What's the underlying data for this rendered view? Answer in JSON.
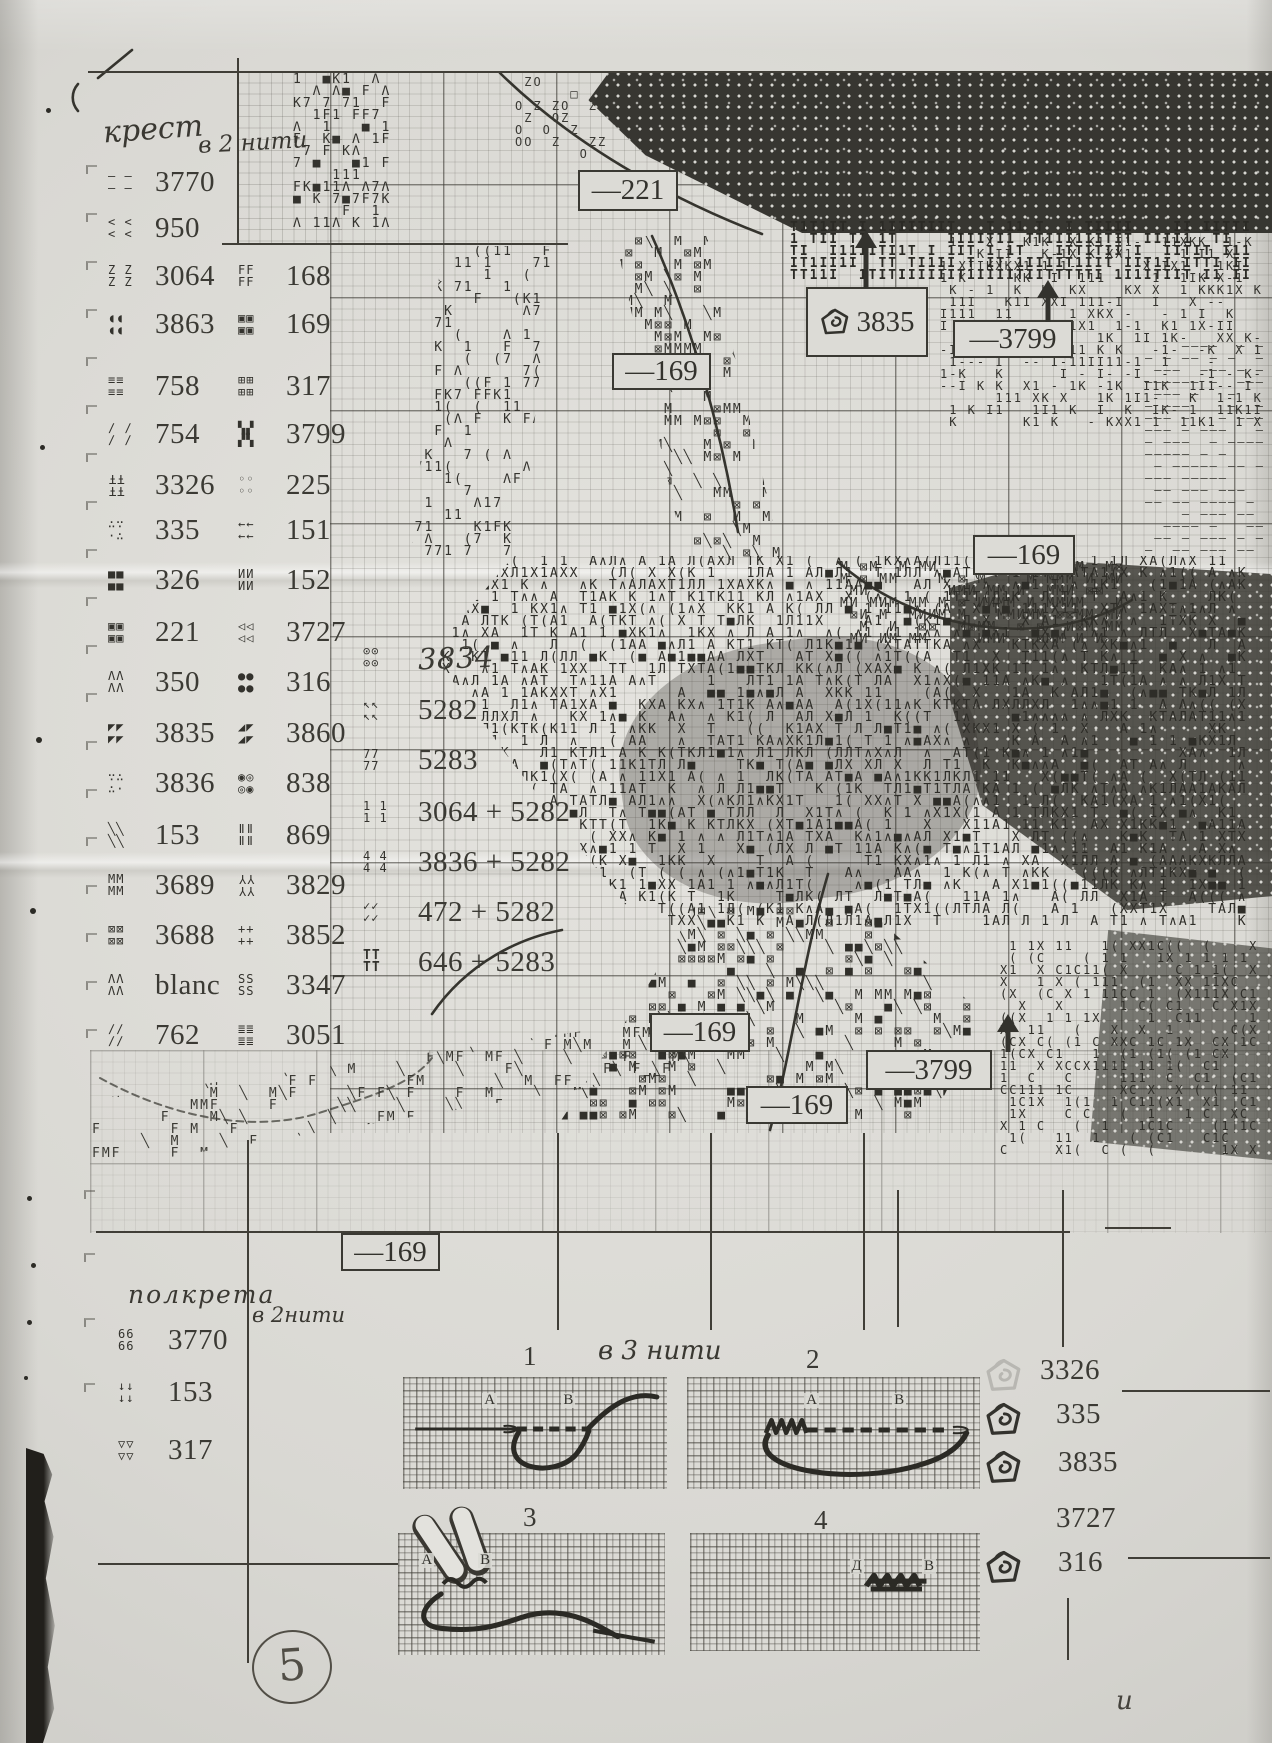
{
  "page": {
    "number": "5",
    "corner_mark": "и"
  },
  "headings": {
    "cross_title": "крест",
    "cross_threads": "в 2 нити",
    "half_title": "полкрета",
    "half_threads": "в 2нити",
    "diagram_threads": "в 3 нити"
  },
  "legend_cross": {
    "col1": [
      {
        "sym": [
          "– –",
          "– –"
        ],
        "code": "3770",
        "y": 170
      },
      {
        "sym": [
          "< <",
          "< <"
        ],
        "code": "950",
        "y": 216
      },
      {
        "sym": [
          "Z Z",
          "Z Z"
        ],
        "code": "3064",
        "y": 264
      },
      {
        "sym": [
          "◖◖",
          "◖◖"
        ],
        "code": "3863",
        "y": 312
      },
      {
        "sym": [
          "≡≡",
          "≡≡"
        ],
        "code": "758",
        "y": 374
      },
      {
        "sym": [
          "∕ ∕",
          "∕ ∕"
        ],
        "code": "754",
        "y": 422
      },
      {
        "sym": [
          "ŦŦ",
          "ŦŦ"
        ],
        "flip": true,
        "code": "3326",
        "y": 473
      },
      {
        "sym": [
          "∴∵",
          "·∴"
        ],
        "code": "335",
        "y": 518
      },
      {
        "sym": [
          "■■",
          "■■"
        ],
        "code": "326",
        "y": 568
      },
      {
        "sym": [
          "▣▣",
          "▣▣"
        ],
        "code": "221",
        "y": 620
      },
      {
        "sym": [
          "ΛΛ",
          "ΛΛ"
        ],
        "code": "350",
        "y": 670
      },
      {
        "sym": [
          "◤◤",
          "◤◤"
        ],
        "code": "3835",
        "y": 721
      },
      {
        "sym": [
          "∵∴",
          "∴·"
        ],
        "code": "3836",
        "y": 771
      },
      {
        "sym": [
          "╲╲",
          "╲╲"
        ],
        "code": "153",
        "y": 823
      },
      {
        "sym": [
          "MM",
          "MM"
        ],
        "code": "3689",
        "y": 873
      },
      {
        "sym": [
          "⊠⊠",
          "⊠⊠"
        ],
        "code": "3688",
        "y": 923
      },
      {
        "sym": [
          "ΛΛ",
          "ΛΛ"
        ],
        "code": "blanc",
        "y": 973
      },
      {
        "sym": [
          "∕∕",
          "∕∕"
        ],
        "code": "762",
        "y": 1023
      }
    ],
    "col2": [
      {
        "sym": [
          "FF",
          "FF"
        ],
        "code": "168",
        "y": 264
      },
      {
        "sym": [
          "▣▣",
          "▣▣"
        ],
        "code": "169",
        "y": 312
      },
      {
        "sym": [
          "⊞⊞",
          "⊞⊞"
        ],
        "code": "317",
        "y": 374
      },
      {
        "sym": [
          "▚▞",
          "▞▚"
        ],
        "code": "3799",
        "y": 422
      },
      {
        "sym": [
          "◦◦",
          "◦◦"
        ],
        "code": "225",
        "y": 473
      },
      {
        "sym": [
          "←←",
          "←←"
        ],
        "code": "151",
        "y": 518
      },
      {
        "sym": [
          "ИИ",
          "ИИ"
        ],
        "code": "152",
        "y": 568
      },
      {
        "sym": [
          "◁◁",
          "◁◁"
        ],
        "code": "3727",
        "y": 620
      },
      {
        "sym": [
          "●●",
          "●●"
        ],
        "code": "316",
        "y": 670
      },
      {
        "sym": [
          "◢◤",
          "◢◤"
        ],
        "code": "3860",
        "y": 721
      },
      {
        "sym": [
          "◉◎",
          "◎◉"
        ],
        "code": "838",
        "y": 771
      },
      {
        "sym": [
          "ǁǁ",
          "ǁǁ"
        ],
        "code": "869",
        "y": 823
      },
      {
        "sym": [
          "ΥΥ",
          "ΥΥ"
        ],
        "flip": true,
        "code": "3829",
        "y": 873
      },
      {
        "sym": [
          "++",
          "++"
        ],
        "code": "3852",
        "y": 923
      },
      {
        "sym": [
          "SS",
          "SS"
        ],
        "code": "3347",
        "y": 973
      },
      {
        "sym": [
          "≣≣",
          "≣≣"
        ],
        "code": "3051",
        "y": 1023
      }
    ],
    "col3": [
      {
        "sym": [
          "⊙⊙",
          "⊙⊙"
        ],
        "code": "3834",
        "hand": true,
        "y": 645
      },
      {
        "sym": [
          "↖↖",
          "↖↖"
        ],
        "code": "5282",
        "y": 698
      },
      {
        "sym": [
          "77",
          "77"
        ],
        "code": "5283",
        "y": 748
      },
      {
        "sym": [
          "1 1",
          "1 1"
        ],
        "code": "3064 + 5282",
        "y": 800
      },
      {
        "sym": [
          "4 4",
          "4 4"
        ],
        "code": "3836 + 5282",
        "y": 850
      },
      {
        "sym": [
          "✓✓",
          "✓✓"
        ],
        "code": "472 + 5282",
        "y": 900
      },
      {
        "sym": [
          "TT",
          "TT"
        ],
        "bold": true,
        "code": "646 + 5283",
        "y": 950
      }
    ]
  },
  "legend_half": [
    {
      "sym": [
        "66",
        "66"
      ],
      "code": "3770",
      "y": 1328
    },
    {
      "sym": [
        "↓↓",
        "↓↓"
      ],
      "code": "153",
      "y": 1380
    },
    {
      "sym": [
        "▽▽",
        "▽▽"
      ],
      "code": "317",
      "y": 1438
    }
  ],
  "knot_list": [
    {
      "code": "3326",
      "icon": "faint",
      "y": 1358,
      "x": 1040
    },
    {
      "code": "335",
      "icon": "knot",
      "y": 1402,
      "x": 1056
    },
    {
      "code": "3835",
      "icon": "knot",
      "y": 1450,
      "x": 1058
    },
    {
      "code": "3727",
      "icon": "none",
      "y": 1506,
      "x": 1056
    },
    {
      "code": "316",
      "icon": "knot",
      "y": 1550,
      "x": 1058
    }
  ],
  "callouts": [
    {
      "label": "—221",
      "x": 578,
      "y": 170,
      "w": 96,
      "h": 37
    },
    {
      "label": "—169",
      "x": 612,
      "y": 353,
      "w": 95,
      "h": 33
    },
    {
      "label": "3835",
      "x": 806,
      "y": 287,
      "w": 118,
      "h": 66,
      "icon": "knot"
    },
    {
      "label": "—3799",
      "x": 953,
      "y": 320,
      "w": 116,
      "h": 34
    },
    {
      "label": "—169",
      "x": 973,
      "y": 535,
      "w": 98,
      "h": 36
    },
    {
      "label": "—169",
      "x": 650,
      "y": 1013,
      "w": 96,
      "h": 35
    },
    {
      "label": "—3799",
      "x": 866,
      "y": 1050,
      "w": 122,
      "h": 36
    },
    {
      "label": "—169",
      "x": 746,
      "y": 1086,
      "w": 98,
      "h": 34
    },
    {
      "label": "—169",
      "x": 341,
      "y": 1233,
      "w": 95,
      "h": 34
    }
  ],
  "arrows": [
    {
      "x": 866,
      "y": 230,
      "h": 58
    },
    {
      "x": 1048,
      "y": 280,
      "h": 42
    },
    {
      "x": 1008,
      "y": 1014,
      "h": 38
    }
  ],
  "diagram_numbers": [
    {
      "t": "1",
      "x": 523,
      "y": 1341
    },
    {
      "t": "2",
      "x": 806,
      "y": 1344
    },
    {
      "t": "3",
      "x": 523,
      "y": 1502
    },
    {
      "t": "4",
      "x": 814,
      "y": 1505
    }
  ],
  "panels": [
    {
      "x": 403,
      "y": 1377,
      "w": 264,
      "h": 112,
      "letters": [
        {
          "t": "А",
          "x": 30,
          "y": 14
        },
        {
          "t": "В",
          "x": 60,
          "y": 14
        }
      ]
    },
    {
      "x": 687,
      "y": 1377,
      "w": 293,
      "h": 112,
      "letters": [
        {
          "t": "А",
          "x": 40,
          "y": 14
        },
        {
          "t": "В",
          "x": 70,
          "y": 14
        }
      ]
    },
    {
      "x": 398,
      "y": 1533,
      "w": 267,
      "h": 122,
      "letters": [
        {
          "t": "А",
          "x": 8,
          "y": 16
        },
        {
          "t": "В",
          "x": 30,
          "y": 16
        }
      ]
    },
    {
      "x": 690,
      "y": 1533,
      "w": 290,
      "h": 118,
      "letters": [
        {
          "t": "Д",
          "x": 55,
          "y": 22
        },
        {
          "t": "В",
          "x": 80,
          "y": 22
        }
      ]
    }
  ],
  "chart_textures": [
    {
      "glyphs": "КF1Λ7■1",
      "x": 293,
      "y": 74,
      "w": 110,
      "h": 166,
      "density": 0.5,
      "size": 13,
      "color": "#34332e"
    },
    {
      "glyphs": "Λ17К(1F",
      "x": 395,
      "y": 246,
      "w": 165,
      "h": 314,
      "density": 0.42,
      "size": 13,
      "color": "#34332e",
      "clip": "polygon(30% 0,100% 0,80% 100%,10% 100%)"
    },
    {
      "glyphs": "ZО□Z",
      "x": 515,
      "y": 76,
      "w": 95,
      "h": 90,
      "density": 0.4,
      "size": 12,
      "color": "#3a3934"
    },
    {
      "glyphs": "М⊠╲М",
      "x": 615,
      "y": 236,
      "w": 175,
      "h": 326,
      "density": 0.4,
      "size": 13,
      "color": "#33322d",
      "clip": "polygon(0 0,55% 0,100% 100%,42% 100%)"
    },
    {
      "glyphs": "1ХК-І1",
      "x": 940,
      "y": 236,
      "w": 332,
      "h": 200,
      "density": 0.5,
      "size": 12,
      "color": "#33322d"
    },
    {
      "glyphs": "—–",
      "x": 1145,
      "y": 340,
      "w": 127,
      "h": 222,
      "density": 0.55,
      "size": 12,
      "color": "#45443e"
    },
    {
      "glyphs": "ІТІ1",
      "x": 790,
      "y": 222,
      "w": 480,
      "h": 66,
      "density": 0.8,
      "size": 13,
      "color": "#2b2a25",
      "bold": true
    },
    {
      "glyphs": "МИМ⊠М",
      "x": 840,
      "y": 562,
      "w": 300,
      "h": 86,
      "density": 0.55,
      "size": 13,
      "color": "#33322d"
    },
    {
      "glyphs": "Л(1ТАХ■К∧1",
      "x": 432,
      "y": 556,
      "w": 840,
      "h": 376,
      "density": 0.66,
      "size": 13,
      "color": "#2e2d28",
      "clip": "polygon(10% 0,100% 0,100% 100%,26% 100%,10% 56%,0 26%)"
    },
    {
      "glyphs": "⊠М■╲",
      "x": 560,
      "y": 906,
      "w": 440,
      "h": 226,
      "density": 0.42,
      "size": 13,
      "color": "#302f2a",
      "clip": "polygon(32% 0,72% 0,100% 50%,88% 100%,0 100%,18% 46%)"
    },
    {
      "glyphs": "М╲F",
      "x": 92,
      "y": 1016,
      "w": 618,
      "h": 148,
      "density": 0.3,
      "size": 13,
      "color": "#3a3933",
      "clip": "polygon(0 58%,100% 0,100% 38%,10% 100%,0 100%)"
    },
    {
      "glyphs": "1(СХ1",
      "x": 1000,
      "y": 940,
      "w": 272,
      "h": 218,
      "density": 0.5,
      "size": 12,
      "color": "#302f2a"
    }
  ]
}
